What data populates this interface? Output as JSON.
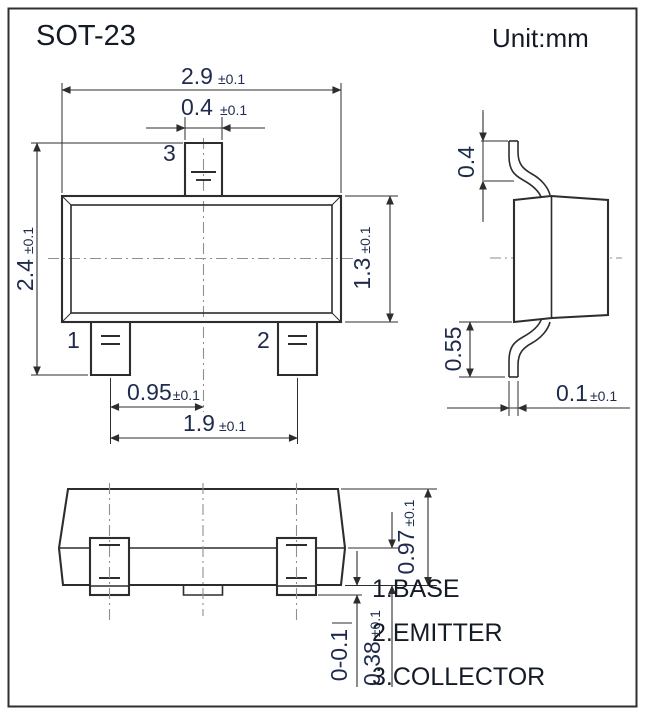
{
  "title": "SOT-23",
  "unit_label": "Unit:mm",
  "legend": {
    "items": [
      "1.BASE",
      "2.EMITTER",
      "3.COLLECTOR"
    ]
  },
  "pin_labels": {
    "pin1": "1",
    "pin2": "2",
    "pin3": "3"
  },
  "dimensions": {
    "top_view": {
      "body_width": {
        "value": "2.9",
        "tol": "±0.1"
      },
      "pin3_width": {
        "value": "0.4",
        "tol": "±0.1"
      },
      "overall_depth": {
        "value": "2.4",
        "tol": "±0.1"
      },
      "body_depth": {
        "value": "1.3",
        "tol": "±0.1"
      },
      "pin_pitch": {
        "value": "0.95",
        "tol": "±0.1"
      },
      "pin_span": {
        "value": "1.9",
        "tol": "±0.1"
      }
    },
    "side_view": {
      "upper_lead": {
        "value": "0.4"
      },
      "lower_lead": {
        "value": "0.55"
      },
      "lead_thickness": {
        "value": "0.1",
        "tol": "±0.1"
      }
    },
    "front_view": {
      "body_height": {
        "value": "0.97",
        "tol": "±0.1"
      },
      "lead_height": {
        "value": "0.38",
        "tol": "±0.1"
      },
      "standoff": {
        "value": "0-0.1"
      }
    }
  },
  "colors": {
    "line": "#2d2d2d",
    "dimension_text": "#1f2b4d",
    "heading_text": "#141a26",
    "centerline": "#8f8f8f"
  }
}
